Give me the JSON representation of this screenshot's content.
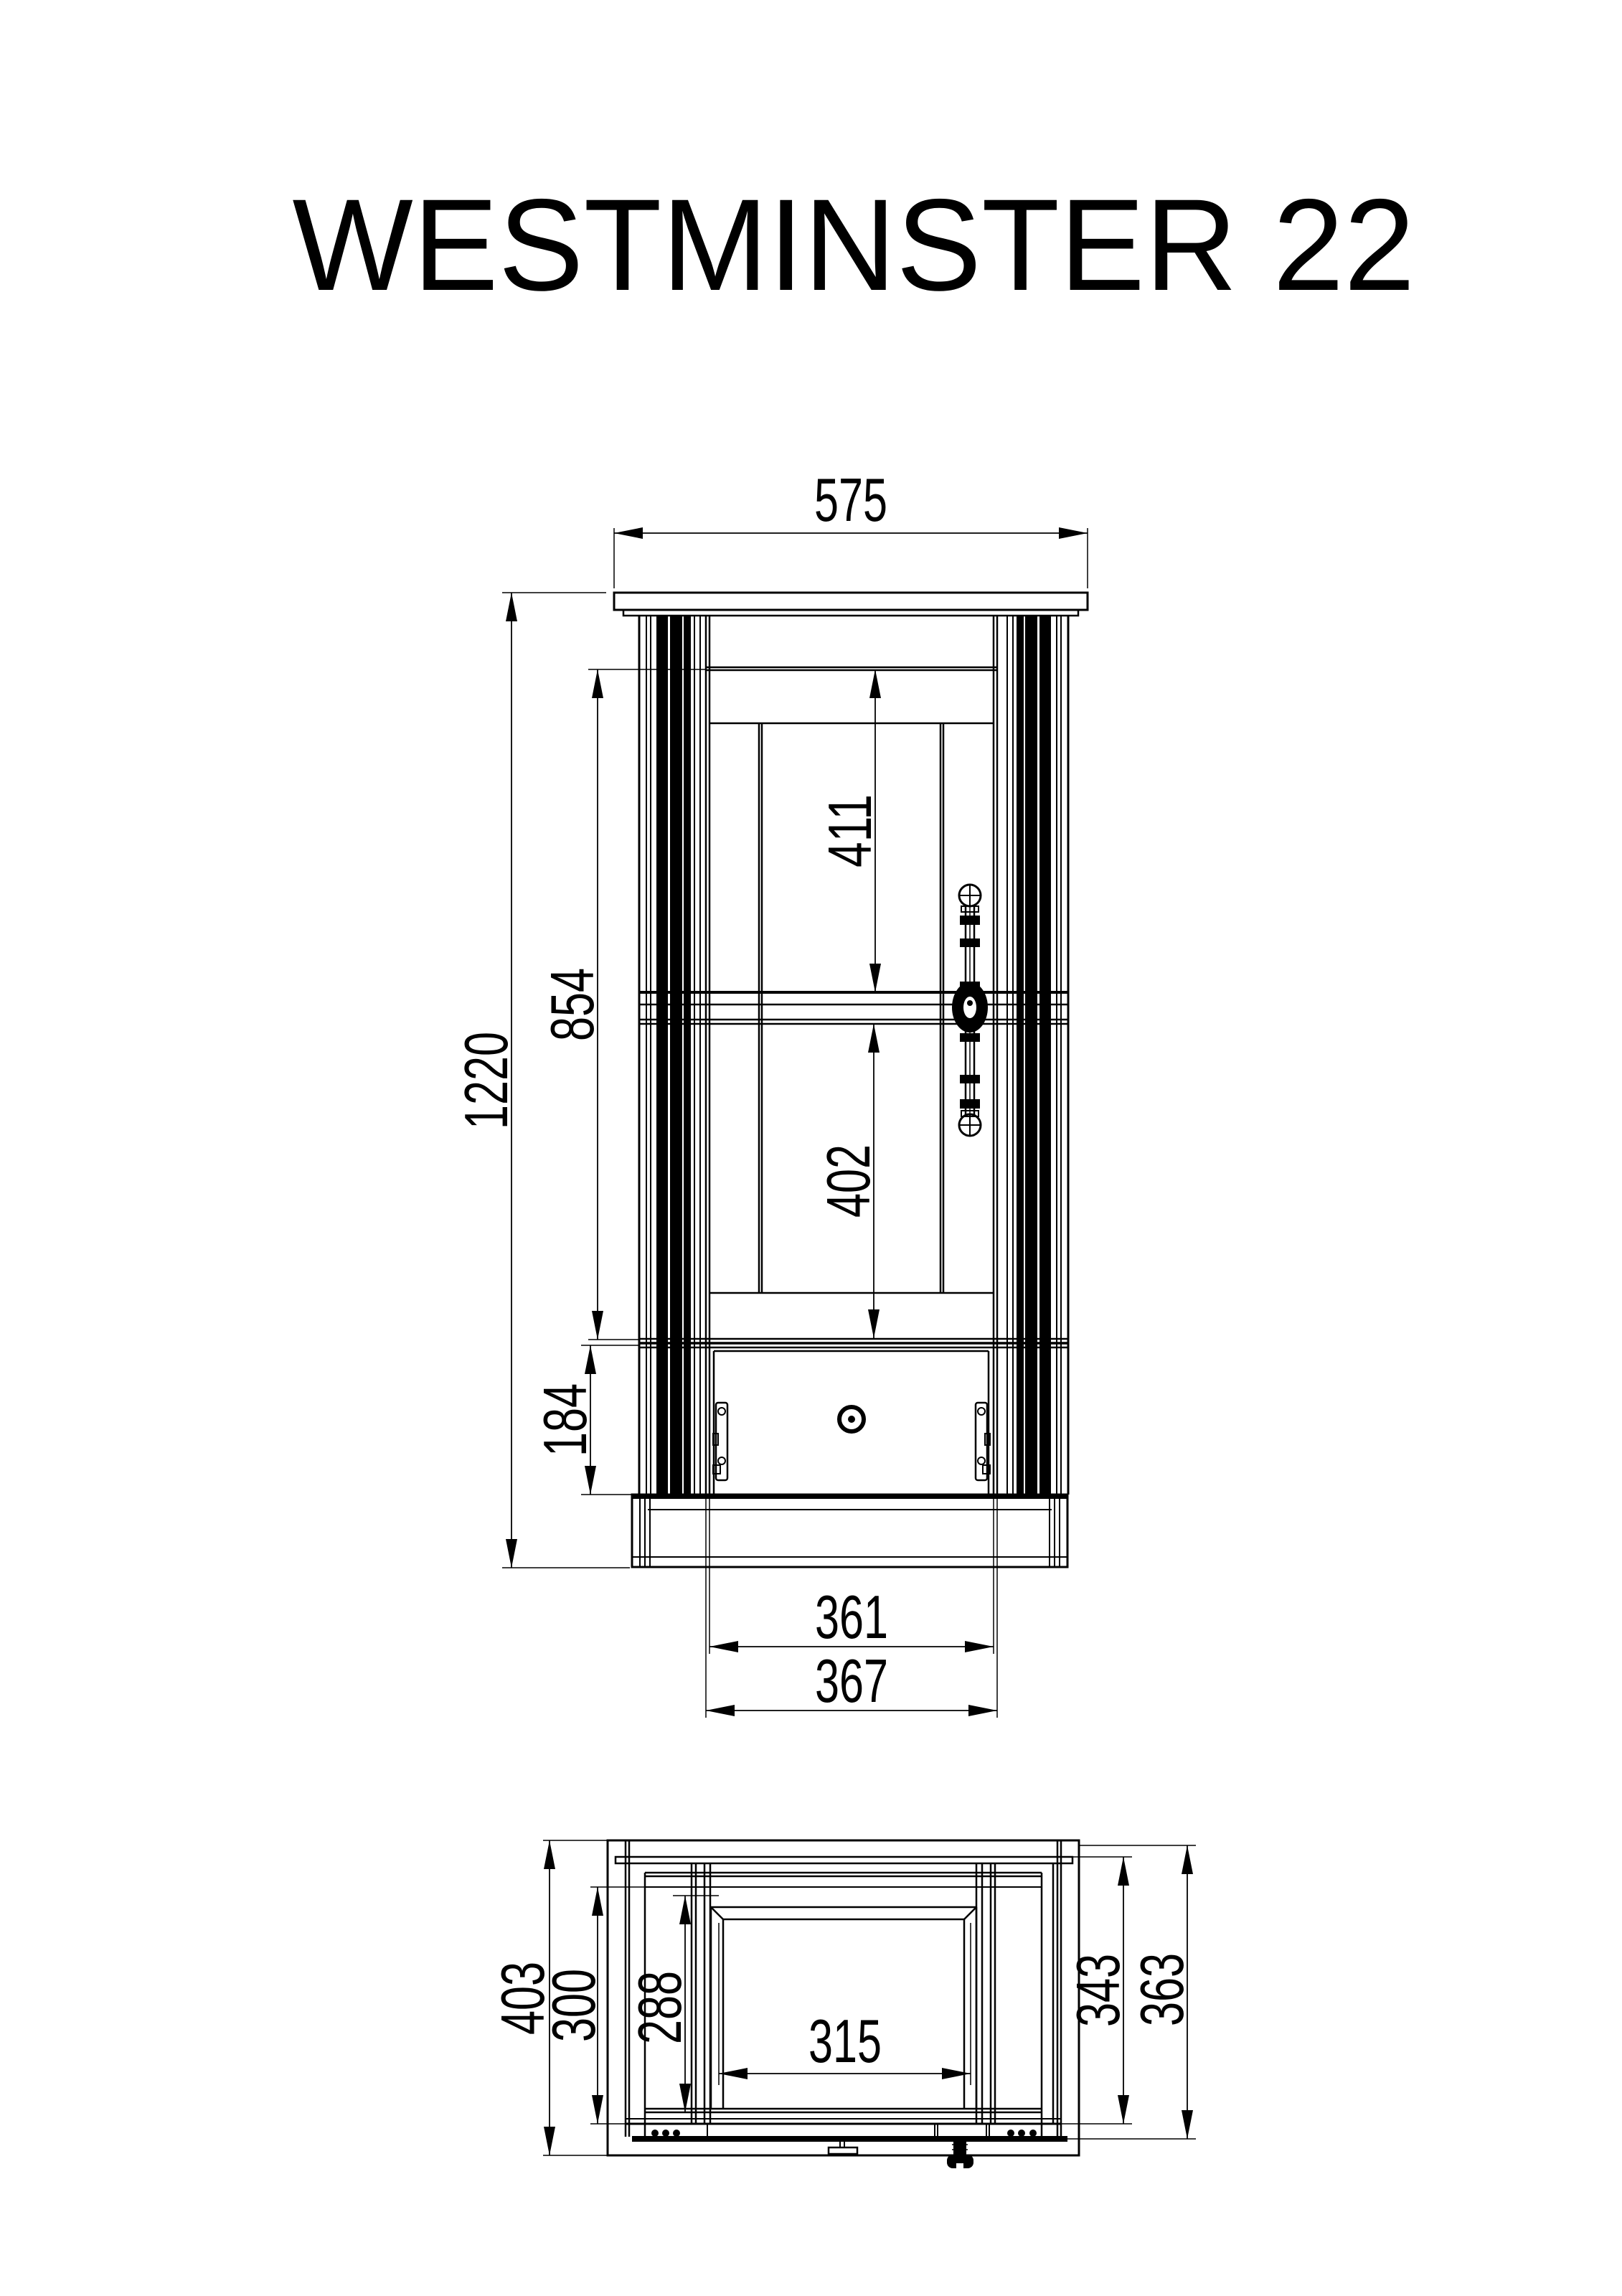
{
  "title": "WESTMINSTER 22",
  "front_view": {
    "width_top": "575",
    "height_total": "1220",
    "door_height": "854",
    "upper_compartment": "411",
    "lower_compartment": "402",
    "drawer_height": "184",
    "drawer_width_inner": "361",
    "drawer_width_outer": "367"
  },
  "top_view": {
    "depth_total": "403",
    "depth_inner": "300",
    "depth_clear": "288",
    "width_inner": "315",
    "depth_side": "343",
    "depth_door": "363"
  },
  "colors": {
    "line": "#000000",
    "background": "#ffffff"
  }
}
